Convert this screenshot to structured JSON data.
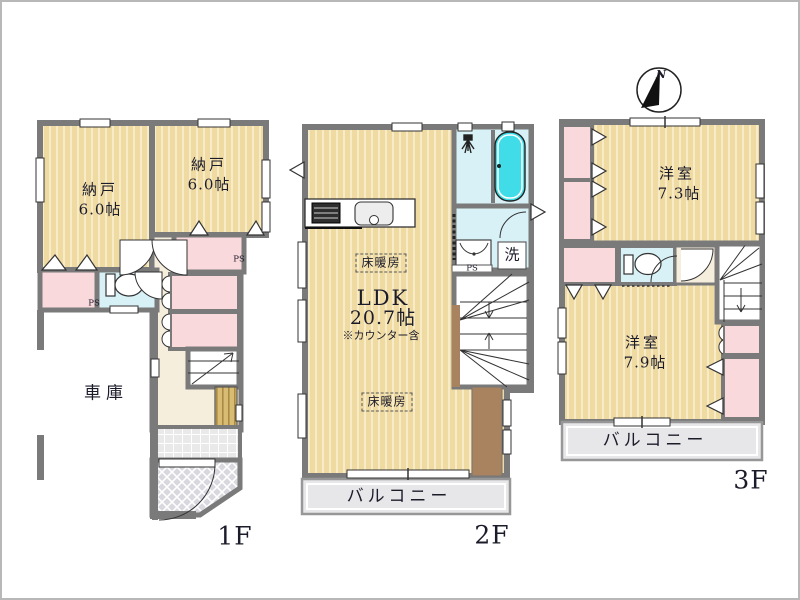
{
  "compass": {
    "north": "N"
  },
  "floor1": {
    "room1_name": "納戸",
    "room1_size": "6.0帖",
    "room2_name": "納戸",
    "room2_size": "6.0帖",
    "garage": "車庫",
    "ps_left": "PS",
    "ps_right": "PS",
    "floor_label": "1F"
  },
  "floor2": {
    "ldk_title": "LDK",
    "ldk_size": "20.7帖",
    "ldk_note": "※カウンター含",
    "floor_heating_top": "床暖房",
    "floor_heating_bottom": "床暖房",
    "wash": "洗",
    "ps": "PS",
    "balcony": "バルコニー",
    "floor_label": "2F"
  },
  "floor3": {
    "room1_name": "洋室",
    "room1_size": "7.3帖",
    "room2_name": "洋室",
    "room2_size": "7.9帖",
    "balcony": "バルコニー",
    "floor_label": "3F"
  },
  "colors": {
    "wall": "#7a7a7a",
    "wood_floor": "#efdaa2",
    "wood_stripe": "#f8ecc8",
    "closet_pink": "#fad9dc",
    "wet_cyan": "#d8f1f6",
    "bathtub": "#40dde8",
    "hall_cream": "#f6eedd",
    "balcony_gray": "#e7e7ea",
    "counter_brown": "#a9825f",
    "cabinet_wood": "#d8bc74"
  }
}
